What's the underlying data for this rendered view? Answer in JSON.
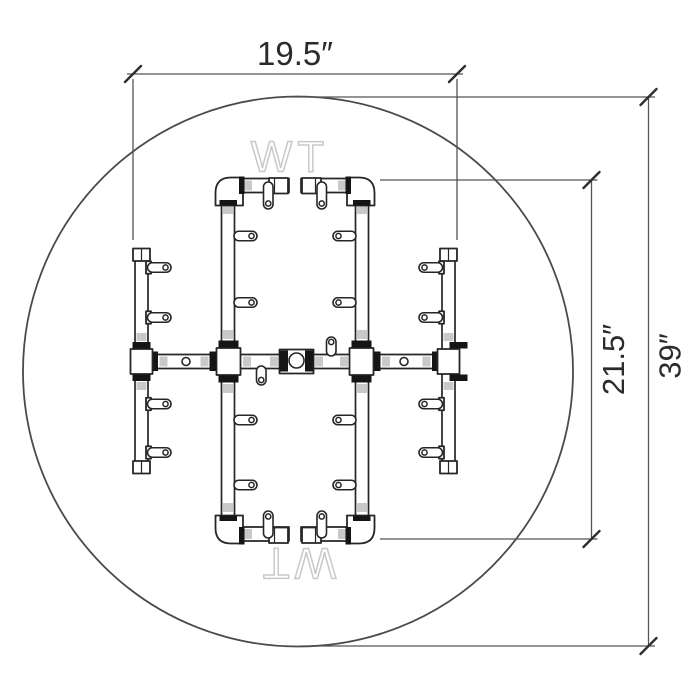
{
  "canvas": {
    "background": "#ffffff"
  },
  "diagram": {
    "type": "dimensioned-technical-drawing",
    "subject": "burner-pipe-assembly-in-round-top-view",
    "watermarks": {
      "top": "WT",
      "bottom": "WT"
    },
    "dimensions": {
      "width": {
        "label": "19.5″",
        "value": 19.5,
        "unit": "in",
        "orientation": "horizontal"
      },
      "depth": {
        "label": "21.5″",
        "value": 21.5,
        "unit": "in",
        "orientation": "vertical"
      },
      "diameter": {
        "label": "39″",
        "value": 39,
        "unit": "in",
        "orientation": "vertical"
      }
    },
    "colors": {
      "line": "#262626",
      "dimension_line": "#555555",
      "dimension_text": "#2b2b2b",
      "fitting_band": "#151515",
      "pipe_shade": "#c9c9c9",
      "watermark": "#c9c9c9"
    }
  }
}
